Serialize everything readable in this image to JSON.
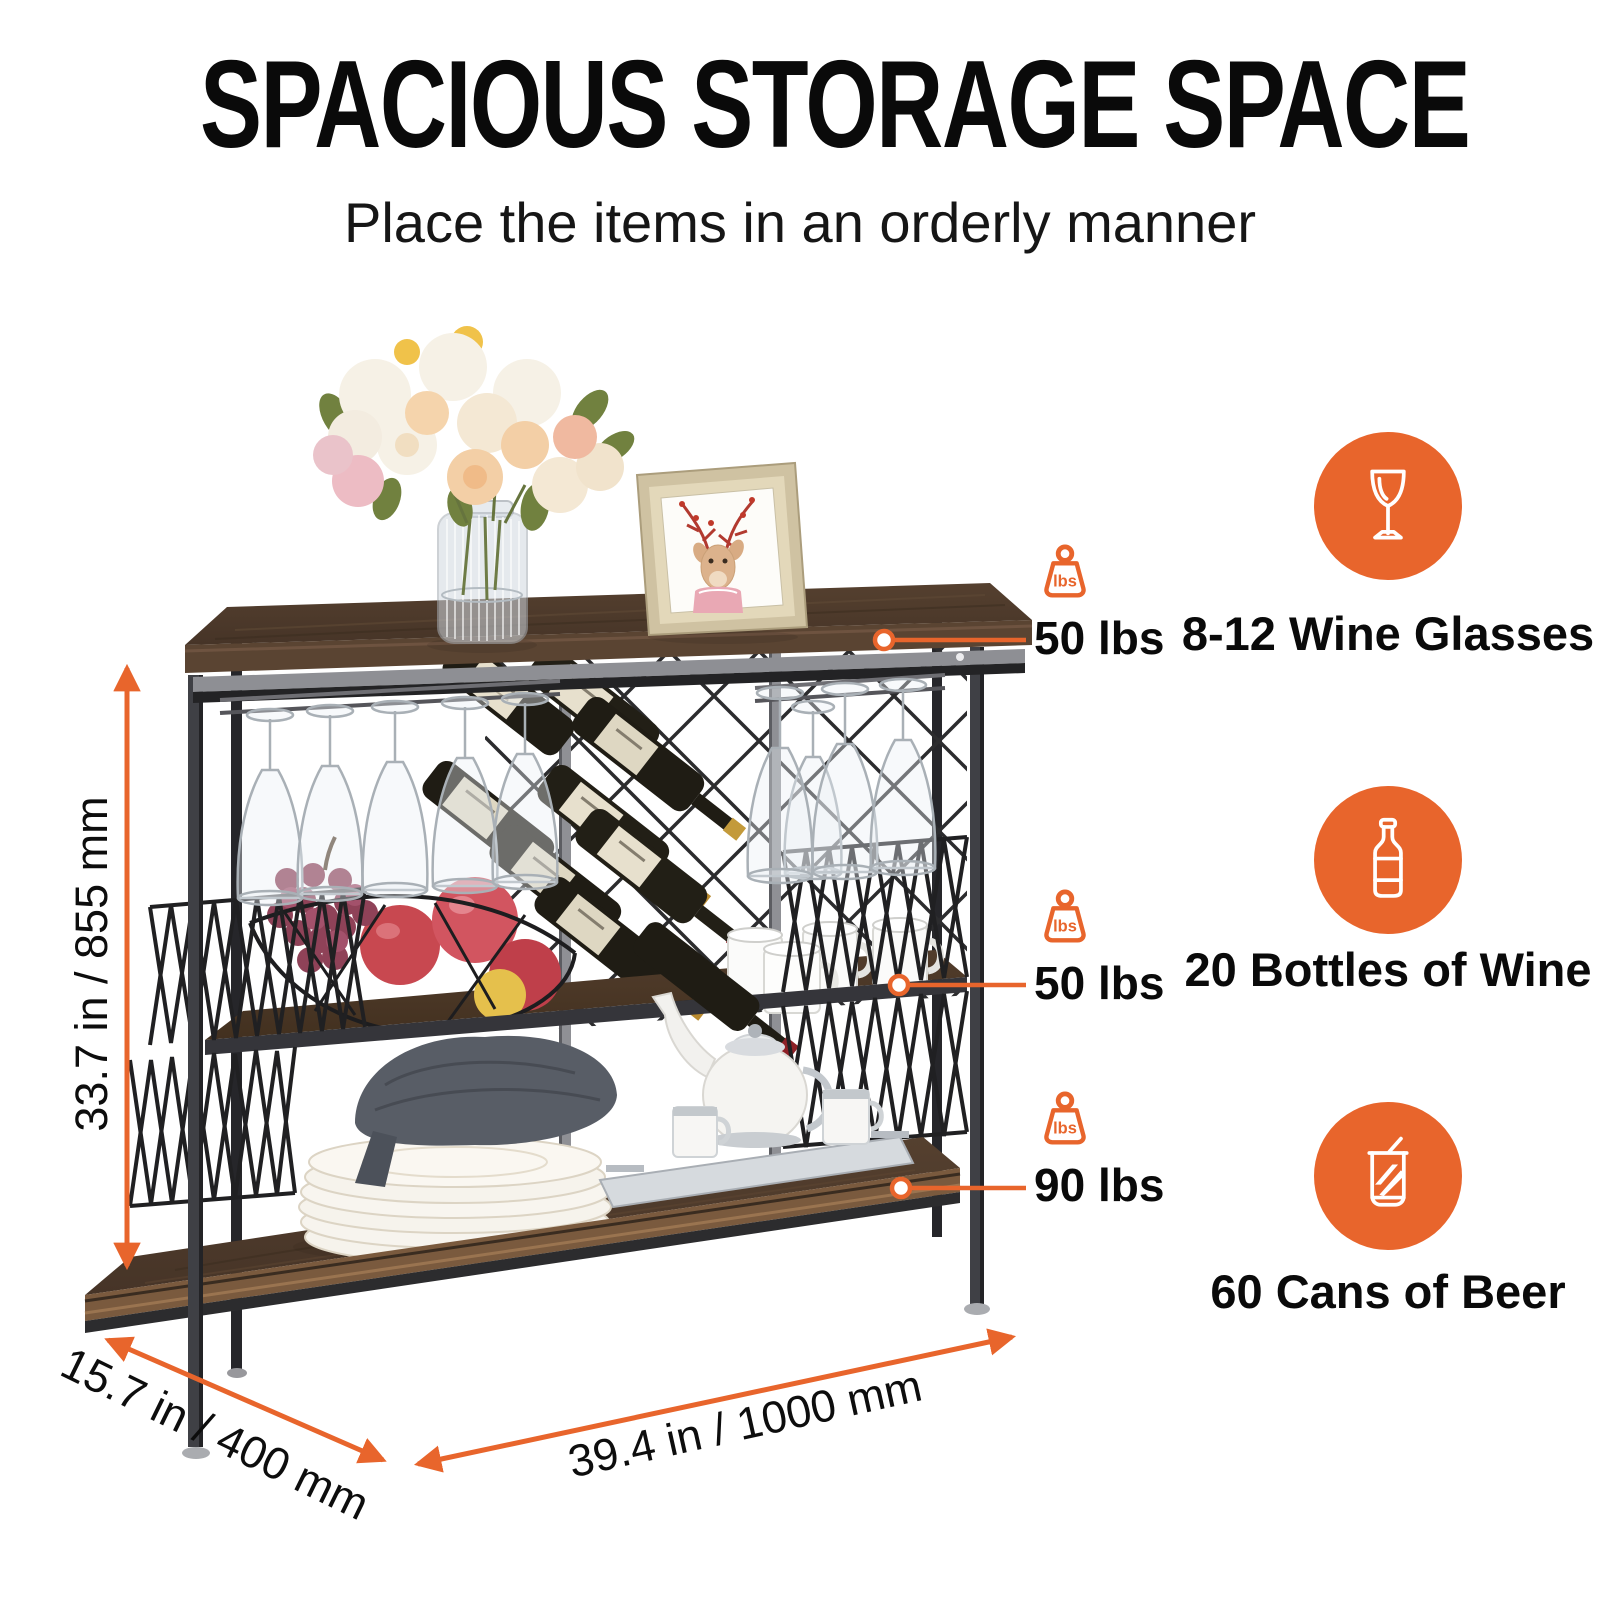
{
  "header": {
    "title": "SPACIOUS STORAGE SPACE",
    "subtitle": "Place the items in an orderly manner"
  },
  "colors": {
    "accent": "#E8652C",
    "text": "#0D0D0D"
  },
  "dimensions": {
    "height_label": "33.7 in / 855 mm",
    "depth_label": "15.7 in / 400 mm",
    "width_label": "39.4 in / 1000 mm"
  },
  "weights": {
    "unit": "lbs",
    "top_label": "50 lbs",
    "middle_label": "50 lbs",
    "bottom_label": "90 lbs"
  },
  "features": [
    {
      "icon": "wine-glass-icon",
      "label": "8-12 Wine Glasses"
    },
    {
      "icon": "wine-bottle-icon",
      "label": "20 Bottles of Wine"
    },
    {
      "icon": "beer-can-icon",
      "label": "60 Cans of Beer"
    }
  ]
}
